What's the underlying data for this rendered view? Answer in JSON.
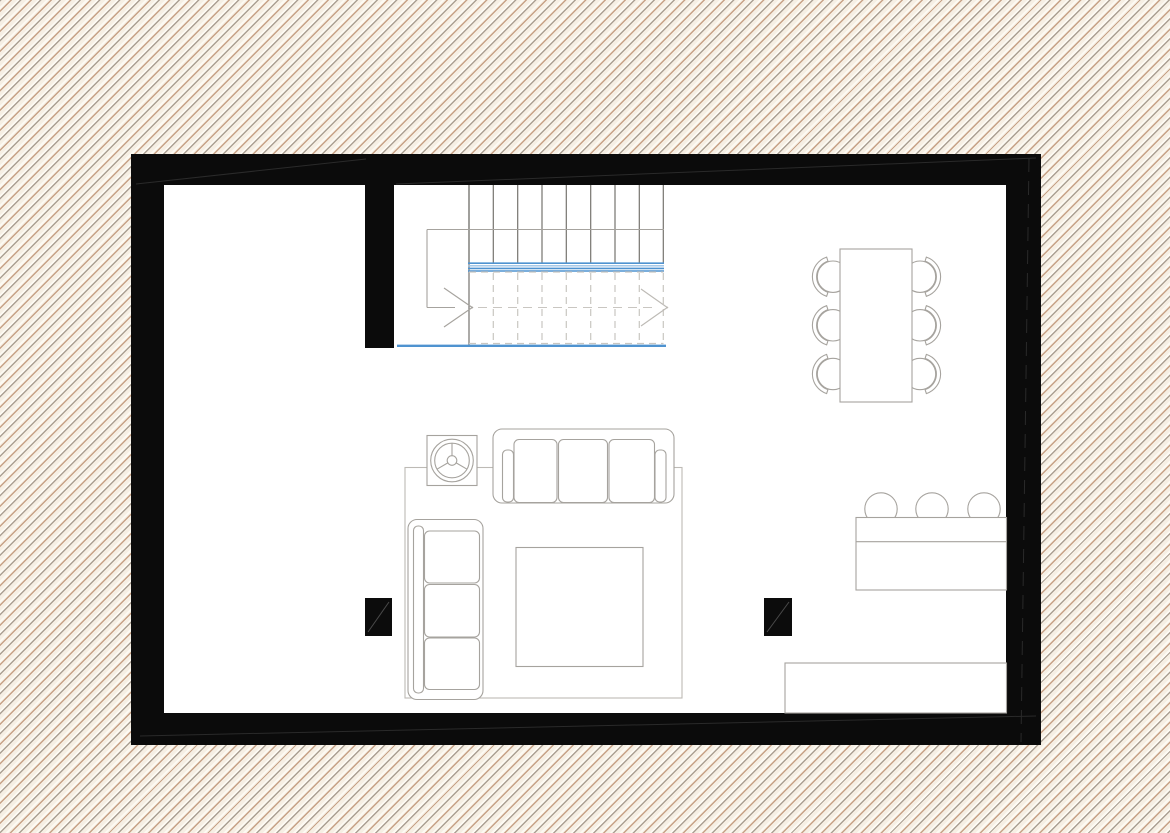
{
  "app": {
    "name": "floor-plan-view",
    "document": "living-level-floor-plan"
  },
  "theme": {
    "canvas_bg_base": "#f6efe4",
    "hatch_gray": "#aba093",
    "hatch_tan": "#c7a287",
    "hatch_highlight": "#fdfaf3",
    "wall": "#0b0b0b",
    "wall_seam": "#2a2a2a",
    "paper": "#ffffff",
    "line": "#a6a39e",
    "line_strong": "#75736e",
    "line_light": "#bdbab5",
    "dash": "#c9c6c1",
    "stair_blue": "#4f93d0",
    "stair_blue_light": "#9cc2e5",
    "column": "#0c0c0c"
  },
  "stairs": {
    "direction": "up-to-right",
    "riser_xs": [
      469,
      493.3,
      517.7,
      542,
      566.3,
      590.7,
      615,
      639.3,
      663.3
    ],
    "riser_y1": 185,
    "riser_y2": 262.5,
    "dashed_xs": [
      493.3,
      517.7,
      542,
      566.3,
      590.7,
      615,
      639.3,
      663.3
    ],
    "dashed_y1": 273,
    "dashed_y2": 343,
    "blue_band_ys": [
      263.2,
      265.8,
      268.4,
      271.0
    ],
    "blue_band_x1": 468,
    "blue_band_x2": 664,
    "blue_base": {
      "x1": 397,
      "x2": 666,
      "y": 345.8
    }
  },
  "dining": {
    "table": {
      "x": 840,
      "y": 249,
      "w": 72,
      "h": 153
    },
    "chair_count": 6,
    "chairs": [
      {
        "cx": 833,
        "cy": 276.7,
        "side": "left"
      },
      {
        "cx": 833,
        "cy": 325.3,
        "side": "left"
      },
      {
        "cx": 833,
        "cy": 374.0,
        "side": "left"
      },
      {
        "cx": 920,
        "cy": 276.7,
        "side": "right"
      },
      {
        "cx": 920,
        "cy": 325.3,
        "side": "right"
      },
      {
        "cx": 920,
        "cy": 374.0,
        "side": "right"
      }
    ],
    "seat_r": 15.7,
    "back_r_outer": 20.6,
    "back_r_inner": 16.4
  },
  "kitchen": {
    "stool_count": 3,
    "stool_xs": [
      881,
      932,
      984
    ],
    "stool_cy": 509,
    "stool_r": 16.2,
    "bar_counter": {
      "x": 856,
      "y": 517.5,
      "w": 150.5,
      "h": 72.5,
      "divider_y": 541.7
    },
    "lower_counter": {
      "x": 785,
      "y": 663,
      "w": 221.5,
      "h": 50
    }
  },
  "columns": [
    {
      "x": 365,
      "y": 598,
      "w": 27,
      "h": 38
    },
    {
      "x": 764,
      "y": 598,
      "w": 28,
      "h": 38
    }
  ],
  "furniture_inventory": [
    "staircase",
    "dining-table",
    "dining-chair",
    "sofa-three-seat-top",
    "sofa-three-seat-left",
    "coffee-table",
    "rug",
    "side-table-with-plant",
    "bar-counter",
    "bar-stool",
    "kitchen-counter",
    "structural-column"
  ]
}
